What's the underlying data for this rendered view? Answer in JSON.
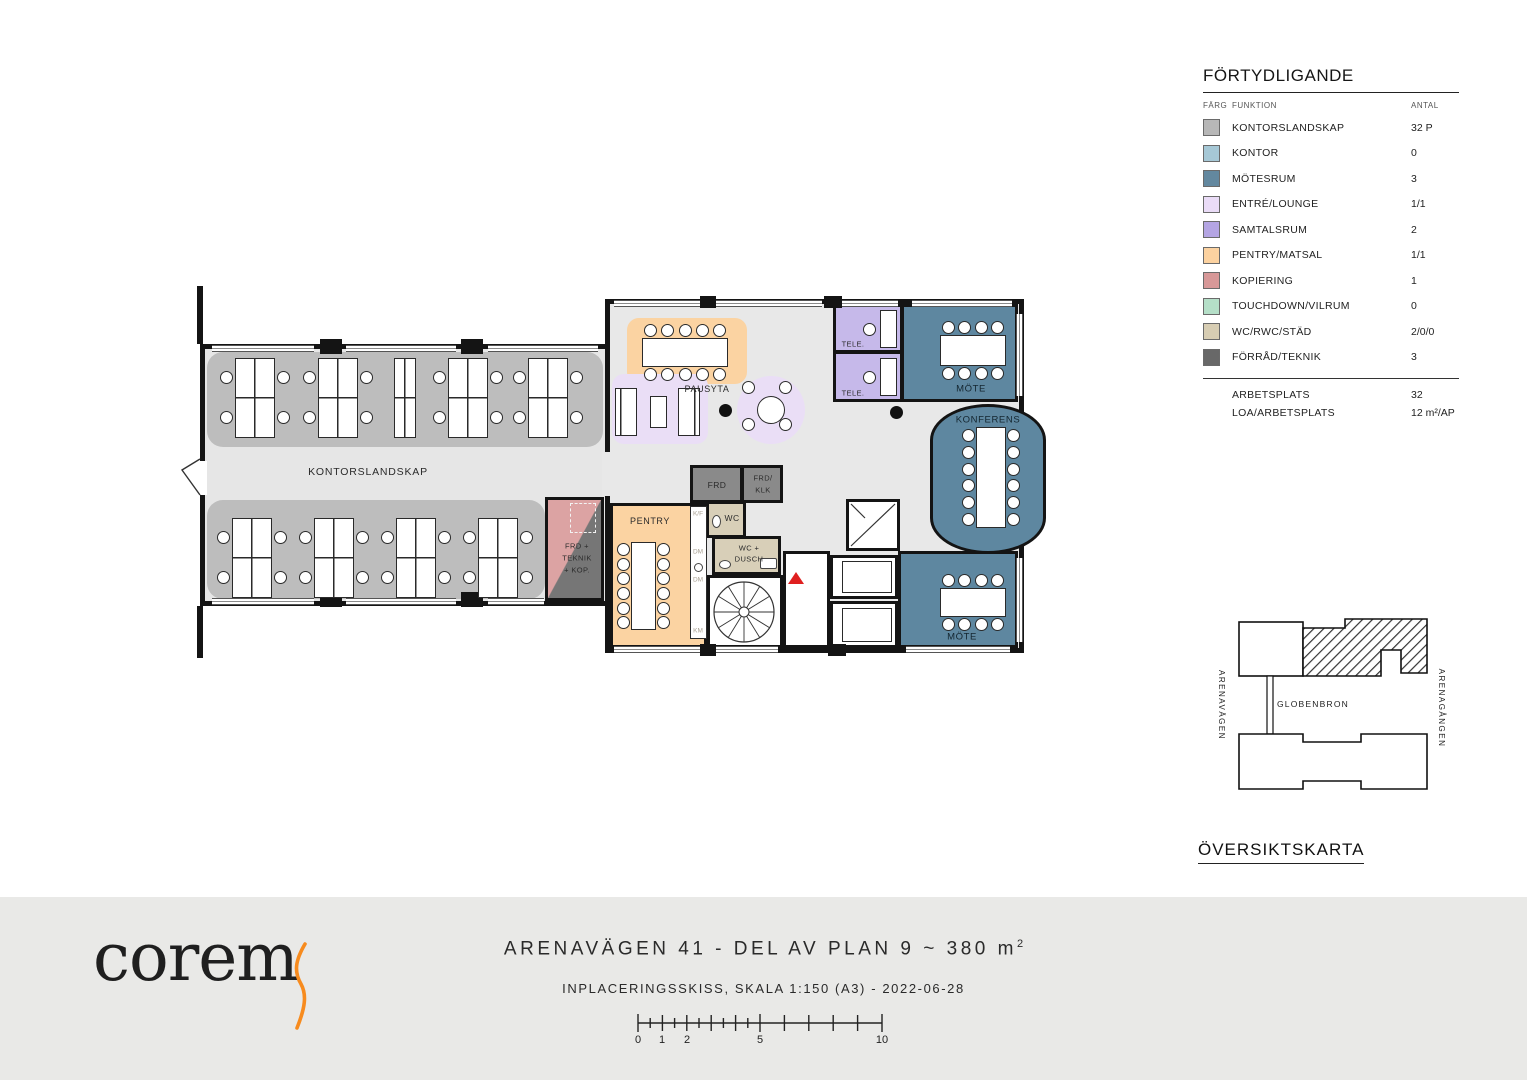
{
  "legend": {
    "title": "FÖRTYDLIGANDE",
    "col_farg": "FÄRG",
    "col_funktion": "FUNKTION",
    "col_antal": "ANTAL",
    "rows": [
      {
        "label": "KONTORSLANDSKAP",
        "antal": "32 P",
        "color": "#b7b7b7"
      },
      {
        "label": "KONTOR",
        "antal": "0",
        "color": "#a6c8d6"
      },
      {
        "label": "MÖTESRUM",
        "antal": "3",
        "color": "#63889f"
      },
      {
        "label": "ENTRÉ/LOUNGE",
        "antal": "1/1",
        "color": "#eadcf7"
      },
      {
        "label": "SAMTALSRUM",
        "antal": "2",
        "color": "#b4a5e3"
      },
      {
        "label": "PENTRY/MATSAL",
        "antal": "1/1",
        "color": "#fcd2a0"
      },
      {
        "label": "KOPIERING",
        "antal": "1",
        "color": "#d79898"
      },
      {
        "label": "TOUCHDOWN/VILRUM",
        "antal": "0",
        "color": "#b5dfc8"
      },
      {
        "label": "WC/RWC/STÄD",
        "antal": "2/0/0",
        "color": "#d7cdb3"
      },
      {
        "label": "FÖRRÅD/TEKNIK",
        "antal": "3",
        "color": "#686868"
      }
    ],
    "summary": [
      {
        "label": "ARBETSPLATS",
        "antal": "32"
      },
      {
        "label": "LOA/ARBETSPLATS",
        "antal": "12 m²/AP"
      }
    ]
  },
  "plan": {
    "labels": {
      "kontorslandskap": "KONTORSLANDSKAP",
      "frd_teknik_1": "FRD +",
      "frd_teknik_2": "TEKNIK",
      "frd_teknik_3": "+ KOP.",
      "pausyta": "PAUSYTA",
      "tele": "TELE.",
      "mote": "MÖTE",
      "konferens": "KONFERENS",
      "frd": "FRD",
      "frd_klk_1": "FRD/",
      "frd_klk_2": "KLK",
      "pentry": "PENTRY",
      "wc": "WC",
      "wc_dusch_1": "WC +",
      "wc_dusch_2": "DUSCH",
      "kf": "K/F",
      "dm": "DM",
      "km": "KM"
    }
  },
  "overview": {
    "title": "ÖVERSIKTSKARTA",
    "street_left": "ARENAVÄGEN",
    "street_right": "ARENAGÅNGEN",
    "bridge": "GLOBENBRON"
  },
  "footer": {
    "logo": "corem",
    "title": "ARENAVÄGEN 41 - DEL AV PLAN 9 ~ 380 m",
    "title_sup": "2",
    "subtitle": "INPLACERINGSSKISS, SKALA 1:150 (A3) - 2022-06-28",
    "scale_labels": [
      "0",
      "1",
      "2",
      "5",
      "10"
    ]
  }
}
